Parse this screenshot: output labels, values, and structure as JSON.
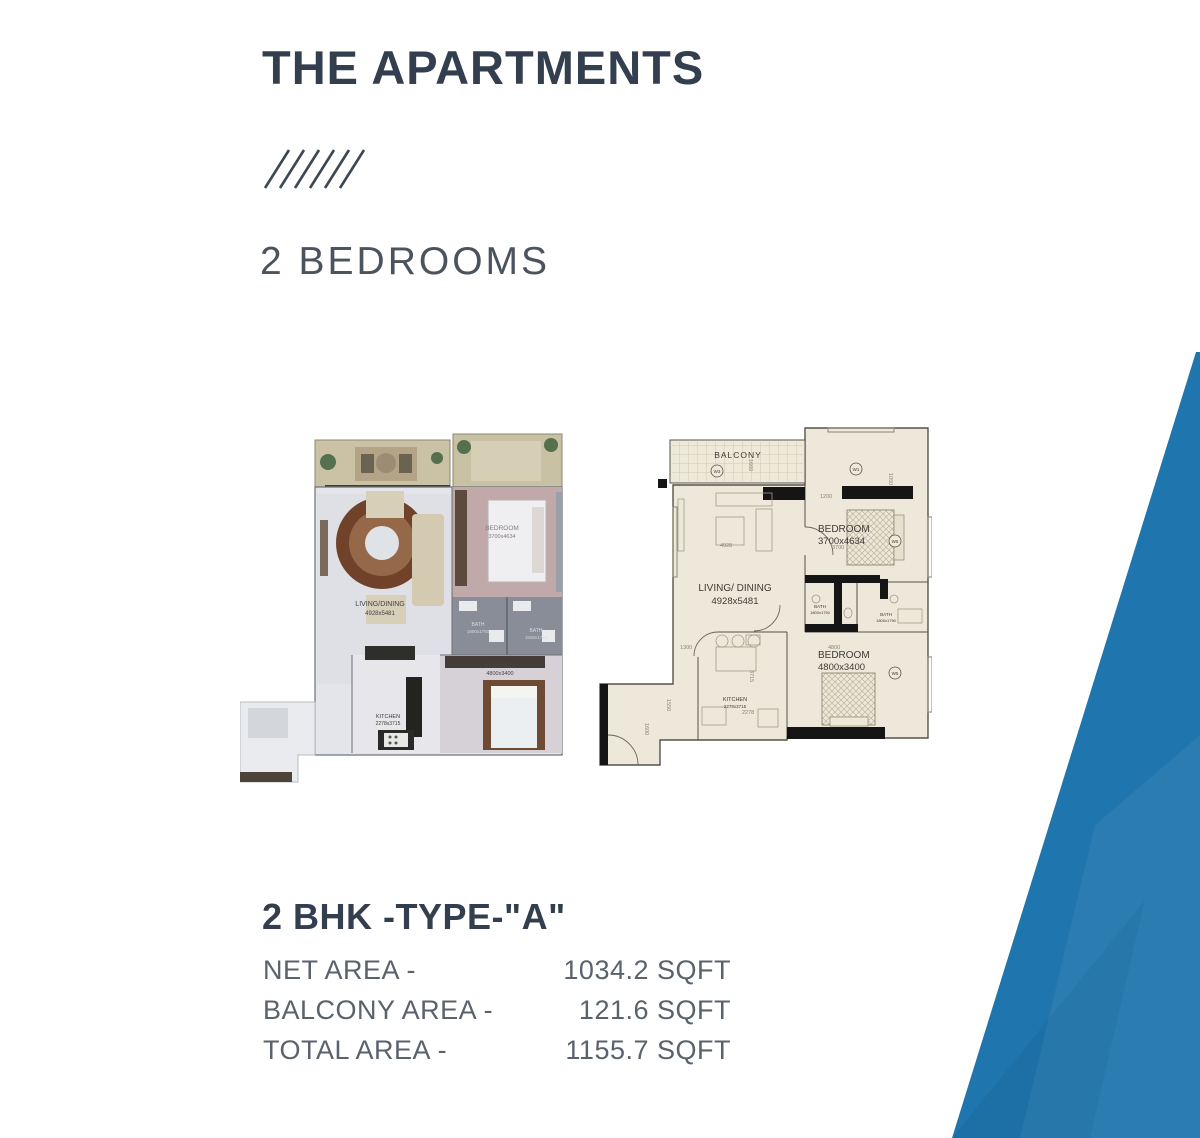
{
  "header": {
    "title": "THE APARTMENTS",
    "subtitle": "2 BEDROOMS"
  },
  "unit": {
    "name": "2 BHK -TYPE-\"A\"",
    "areas": [
      {
        "label": "NET AREA -",
        "value": "1034.2 SQFT"
      },
      {
        "label": "BALCONY AREA -",
        "value": "121.6 SQFT"
      },
      {
        "label": "TOTAL AREA -",
        "value": "1155.7 SQFT"
      }
    ]
  },
  "plans": {
    "left": {
      "living": "LIVING/DINING",
      "living_dim": "4928x5481",
      "bedroom1": "BEDROOM",
      "bedroom1_dim": "3700x4634",
      "bath1": "BATH",
      "bath1_dim": "1800x1750",
      "bath2": "BATH",
      "bath2_dim": "1838x1715",
      "bedroom2": "BEDROOM",
      "bedroom2_dim": "4800x3400",
      "kitchen": "KITCHEN",
      "kitchen_dim": "2278x3715"
    },
    "right": {
      "balcony": "BALCONY",
      "living": "LIVING/ DINING",
      "living_dim": "4928x5481",
      "bedroom1": "BEDROOM",
      "bedroom1_dim": "3700x4634",
      "bedroom2": "BEDROOM",
      "bedroom2_dim": "4800x3400",
      "bath1": "BATH",
      "bath1_dim": "1800x1750",
      "bath2": "BATH",
      "bath2_dim": "1800x1750",
      "kitchen": "KITCHEN",
      "kitchen_dim": "2278x3715",
      "w1": "W1",
      "w3": "W3",
      "w5a": "W5",
      "w5b": "W5",
      "dims": {
        "d1660": "1660",
        "d1200": "1200",
        "d1050": "1050",
        "d4928": "4928",
        "d3700": "3700",
        "d1300": "1300",
        "d1550": "1550",
        "d1600": "1600",
        "d3715": "3715",
        "d2278": "2278",
        "d4800": "4800"
      }
    }
  },
  "colors": {
    "accent_blue": "#1f75ad",
    "heading": "#333e4e",
    "subtitle": "#4b545e",
    "body_text": "#5a626c"
  }
}
